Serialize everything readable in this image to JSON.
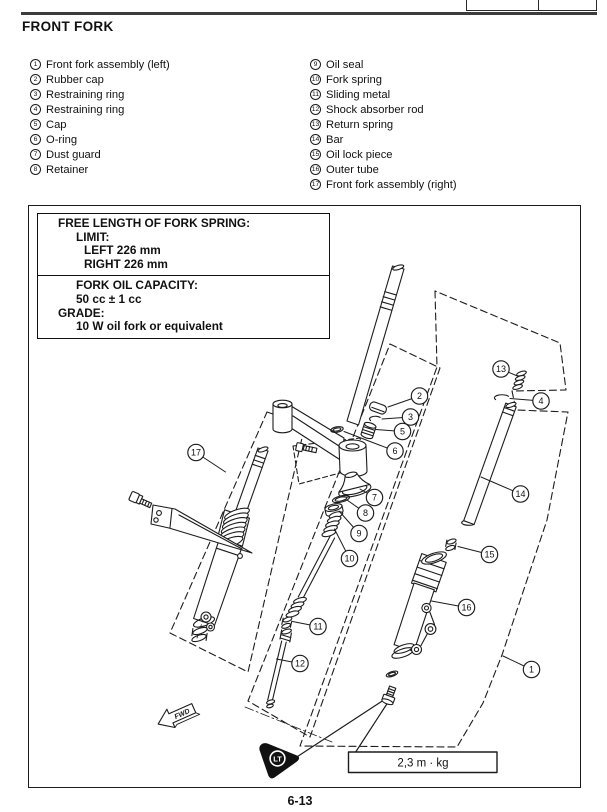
{
  "header": {
    "title": "FRONT FORK"
  },
  "page_number": "6-13",
  "parts_left": [
    {
      "num": "1",
      "label": "Front fork assembly (left)"
    },
    {
      "num": "2",
      "label": "Rubber cap"
    },
    {
      "num": "3",
      "label": "Restraining ring"
    },
    {
      "num": "4",
      "label": "Restraining ring"
    },
    {
      "num": "5",
      "label": "Cap"
    },
    {
      "num": "6",
      "label": "O-ring"
    },
    {
      "num": "7",
      "label": "Dust guard"
    },
    {
      "num": "8",
      "label": "Retainer"
    }
  ],
  "parts_right": [
    {
      "num": "9",
      "label": "Oil seal"
    },
    {
      "num": "10",
      "label": "Fork spring"
    },
    {
      "num": "11",
      "label": "Sliding metal"
    },
    {
      "num": "12",
      "label": "Shock absorber rod"
    },
    {
      "num": "13",
      "label": "Return spring"
    },
    {
      "num": "14",
      "label": "Bar"
    },
    {
      "num": "15",
      "label": "Oil lock piece"
    },
    {
      "num": "16",
      "label": "Outer tube"
    },
    {
      "num": "17",
      "label": "Front fork assembly (right)"
    }
  ],
  "spec_box": {
    "section1": [
      {
        "text": "FREE LENGTH OF FORK SPRING:",
        "indent": 0
      },
      {
        "text": "LIMIT:",
        "indent": 1
      },
      {
        "text": "LEFT 226 mm",
        "indent": 2
      },
      {
        "text": "RIGHT 226 mm",
        "indent": 2
      }
    ],
    "section2": [
      {
        "text": "FORK OIL CAPACITY:",
        "indent": 1
      },
      {
        "text": "50 cc ± 1 cc",
        "indent": 1
      },
      {
        "text": "GRADE:",
        "indent": 0
      },
      {
        "text": "10 W oil fork or equivalent",
        "indent": 1
      }
    ]
  },
  "diagram": {
    "torque_label": "2,3 m · kg",
    "fwd_label": "FWD",
    "loctite_label": "LT",
    "callouts": [
      {
        "num": "1",
        "cx": 531.5,
        "cy": 669.5,
        "lx": 503,
        "ly": 656
      },
      {
        "num": "2",
        "cx": 419.5,
        "cy": 396,
        "lx": 388,
        "ly": 407
      },
      {
        "num": "3",
        "cx": 410.5,
        "cy": 417,
        "lx": 382,
        "ly": 419
      },
      {
        "num": "4",
        "cx": 541,
        "cy": 401,
        "lx": 510,
        "ly": 398.5
      },
      {
        "num": "5",
        "cx": 402.5,
        "cy": 431.5,
        "lx": 376,
        "ly": 429.5
      },
      {
        "num": "6",
        "cx": 395,
        "cy": 451,
        "lx": 344,
        "ly": 431.5
      },
      {
        "num": "7",
        "cx": 374.5,
        "cy": 497.5,
        "lx": 360,
        "ly": 489
      },
      {
        "num": "8",
        "cx": 365.5,
        "cy": 513,
        "lx": 347,
        "ly": 500
      },
      {
        "num": "9",
        "cx": 359,
        "cy": 533.5,
        "lx": 339,
        "ly": 511
      },
      {
        "num": "10",
        "cx": 349.5,
        "cy": 558.5,
        "lx": 334.5,
        "ly": 529
      },
      {
        "num": "11",
        "cx": 318,
        "cy": 626.5,
        "lx": 292.5,
        "ly": 621.5
      },
      {
        "num": "12",
        "cx": 300,
        "cy": 663.5,
        "lx": 276.5,
        "ly": 659
      },
      {
        "num": "13",
        "cx": 501,
        "cy": 369,
        "lx": 518.5,
        "ly": 376.5
      },
      {
        "num": "14",
        "cx": 520.5,
        "cy": 494,
        "lx": 481,
        "ly": 477
      },
      {
        "num": "15",
        "cx": 489.5,
        "cy": 554.5,
        "lx": 458,
        "ly": 546.5
      },
      {
        "num": "16",
        "cx": 466.5,
        "cy": 607.5,
        "lx": 431.5,
        "ly": 601
      },
      {
        "num": "17",
        "cx": 196,
        "cy": 452.5,
        "lx": 225.5,
        "ly": 472
      }
    ]
  }
}
